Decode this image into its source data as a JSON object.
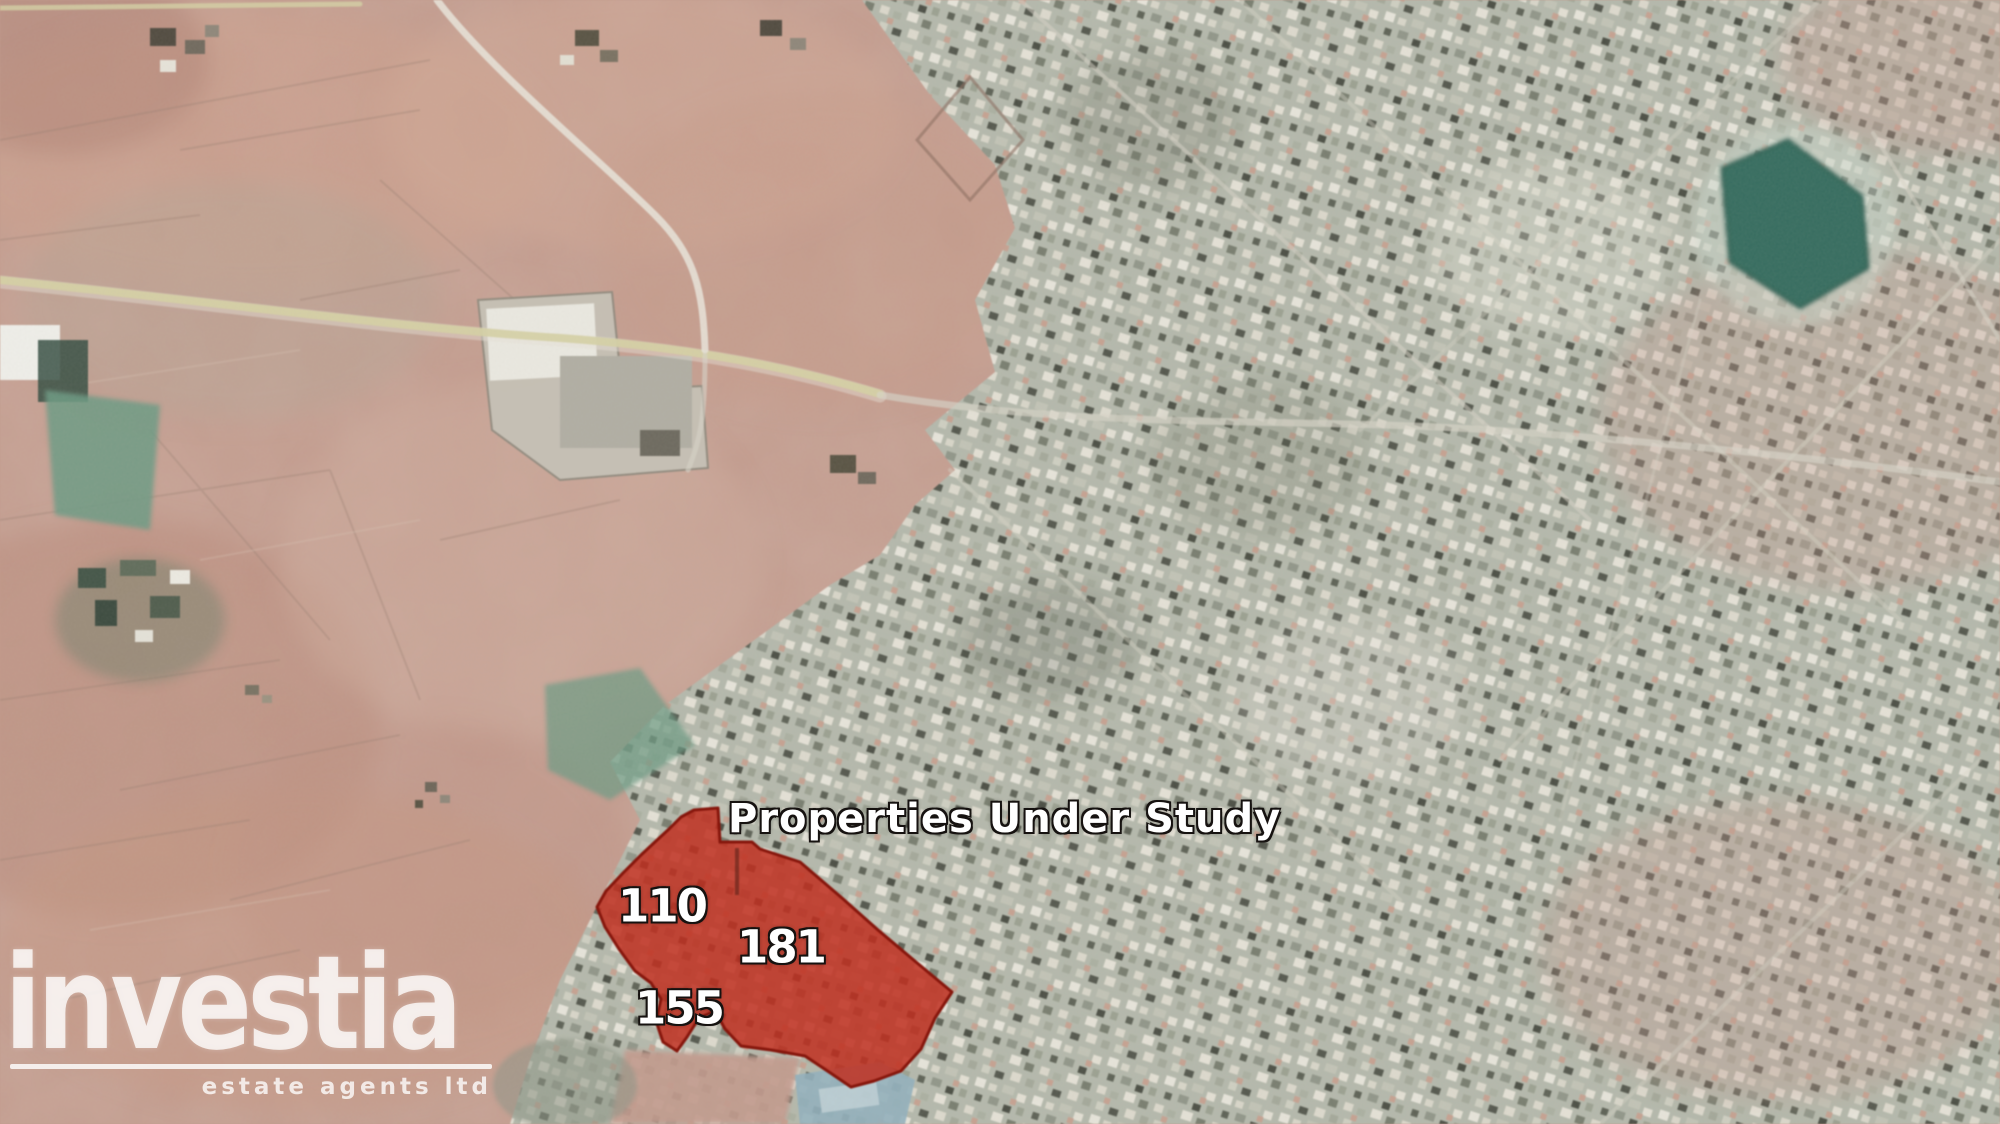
{
  "map": {
    "annotation_title": "Properties Under Study",
    "parcels": [
      {
        "id": "110"
      },
      {
        "id": "181"
      },
      {
        "id": "155"
      }
    ]
  },
  "watermark": {
    "brand": "investia",
    "tagline": "estate agents ltd"
  },
  "colors": {
    "highlight_red": "#c5301f",
    "highlight_border": "#8a150b",
    "label_text": "#ffffff",
    "label_outline": "#161210",
    "farmland_salmon": "#c49a8b",
    "urban_gray": "#b4b9ac",
    "pond_teal": "#2e6a5b",
    "field_green": "#679a82",
    "road_yellow": "#d6d2a2",
    "road_white": "#e9e3d8",
    "watermark_white": "#ffffff"
  }
}
